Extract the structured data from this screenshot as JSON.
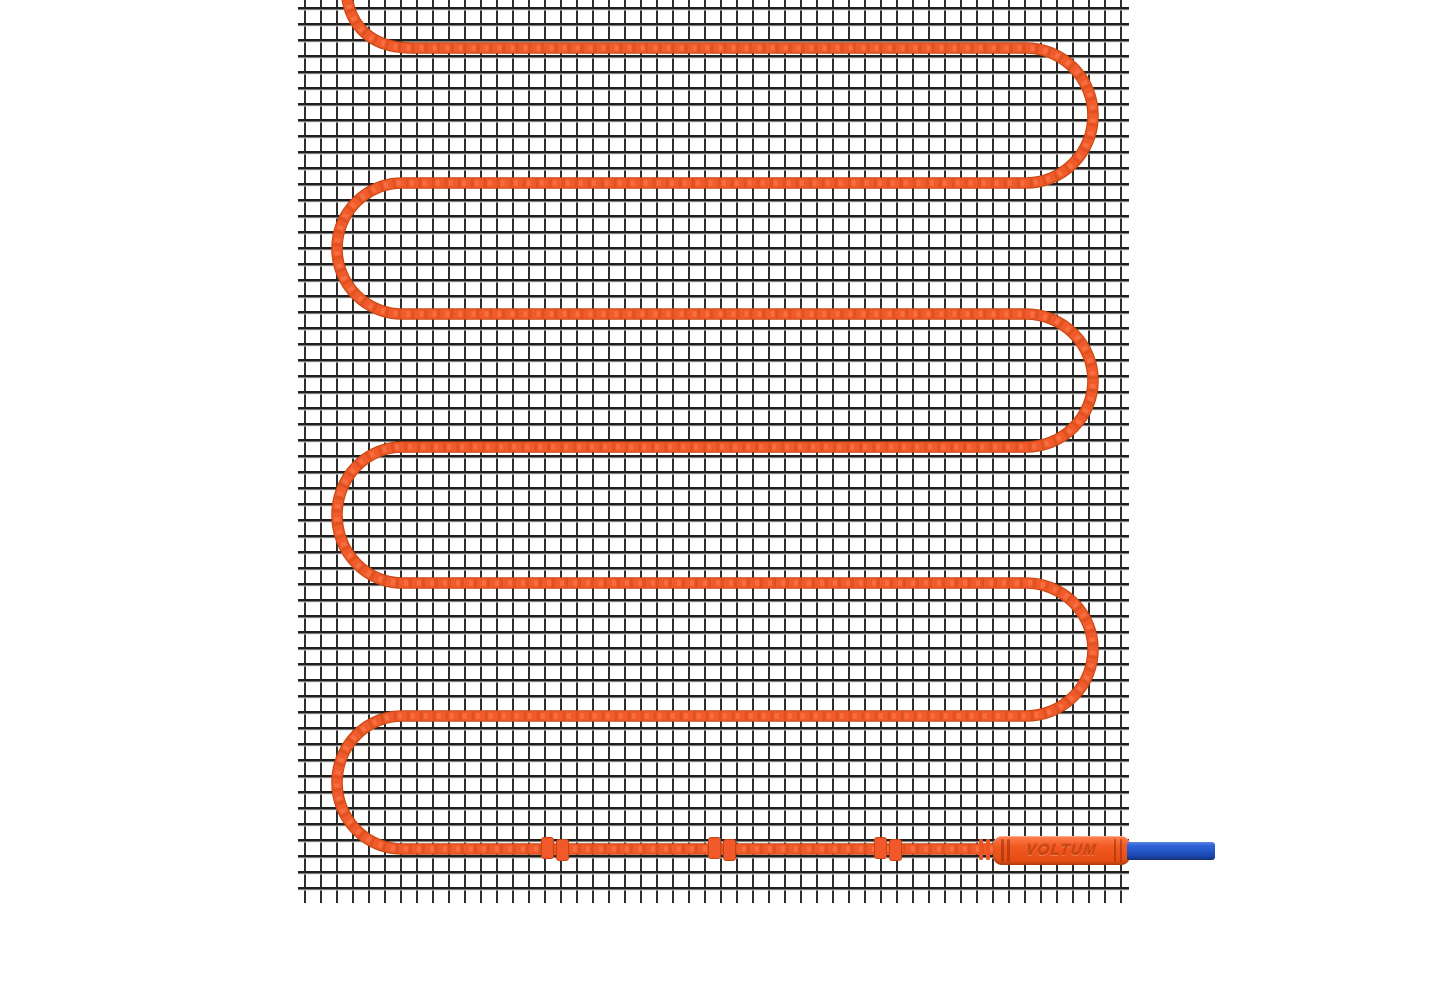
{
  "product": {
    "kind": "electric-underfloor-heating-mat",
    "brand_label": "VOLTUM"
  },
  "colors": {
    "background": "#ffffff",
    "mesh_line_horizontal": "#1f1f1f",
    "mesh_line_vertical": "#2d2d2d",
    "cable_orange": "#f15a2b",
    "cable_outline": "#c64712",
    "connector_orange": "#f25a22",
    "connector_text": "#c94513",
    "cold_lead_blue": "#2254c6"
  },
  "geometry": {
    "mesh": {
      "left": 298,
      "top": 0,
      "width": 831,
      "height": 904,
      "cell_px": 16
    },
    "cable": {
      "entry_top_x": 346,
      "runs_y": [
        48,
        183,
        314,
        447,
        583,
        716,
        849
      ],
      "straight_left_x": 402,
      "straight_right_x": 1026,
      "left_apex_x": 337,
      "right_apex_x": 1093,
      "end_x": 1005,
      "thickness_px": 10
    },
    "clips_x": [
      555,
      722,
      888
    ],
    "connector": {
      "x": 993,
      "y": 836,
      "width": 137,
      "height": 29
    },
    "cold_lead": {
      "x": 1127,
      "y": 842,
      "width": 88,
      "height": 18
    }
  }
}
